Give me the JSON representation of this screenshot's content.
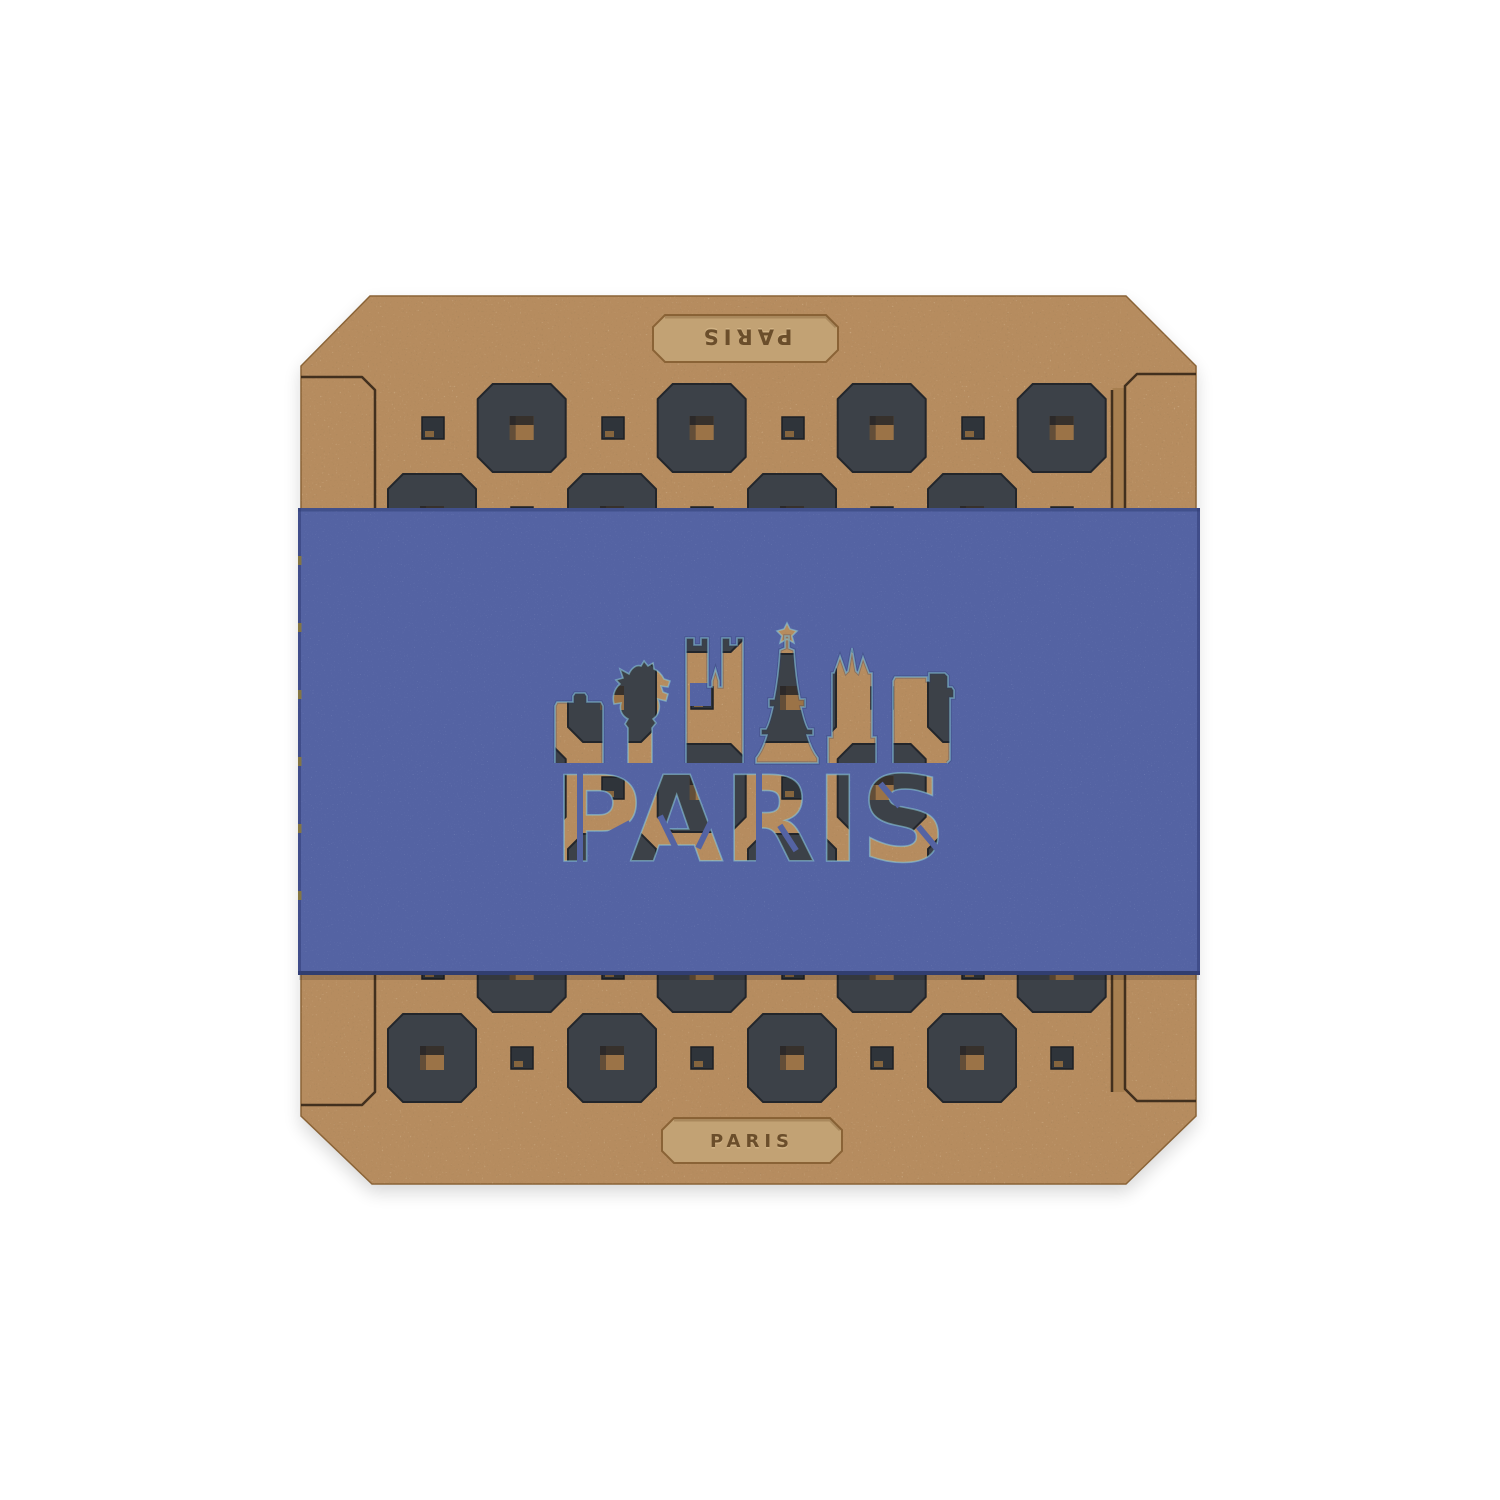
{
  "product": {
    "band_text": "PARIS",
    "top_engraving": "PARIS",
    "bottom_engraving": "PARIS"
  },
  "colors": {
    "background": "#ffffff",
    "wood": "#b68c5f",
    "wood_recess": "#c2a274",
    "tile": "#3c4148",
    "band": "#5463a3",
    "kerf": "#2e2013",
    "engraving": "#6b4e2b",
    "cut_glint": "#8fd0dc"
  },
  "grid": {
    "rows": 8,
    "row_height": 90,
    "first_row_center_y": 428,
    "octagon_size": 88,
    "octagon_chamfer": 15,
    "hole_size": 24,
    "square_size": 22,
    "odd_octagon_centers_x": [
      521.7,
      701.7,
      881.7,
      1061.7
    ],
    "odd_square_centers_x": [
      433,
      613,
      793,
      973
    ],
    "even_octagon_centers_x": [
      432,
      612,
      792,
      972
    ],
    "even_square_centers_x": [
      522,
      702,
      882,
      1062
    ]
  }
}
